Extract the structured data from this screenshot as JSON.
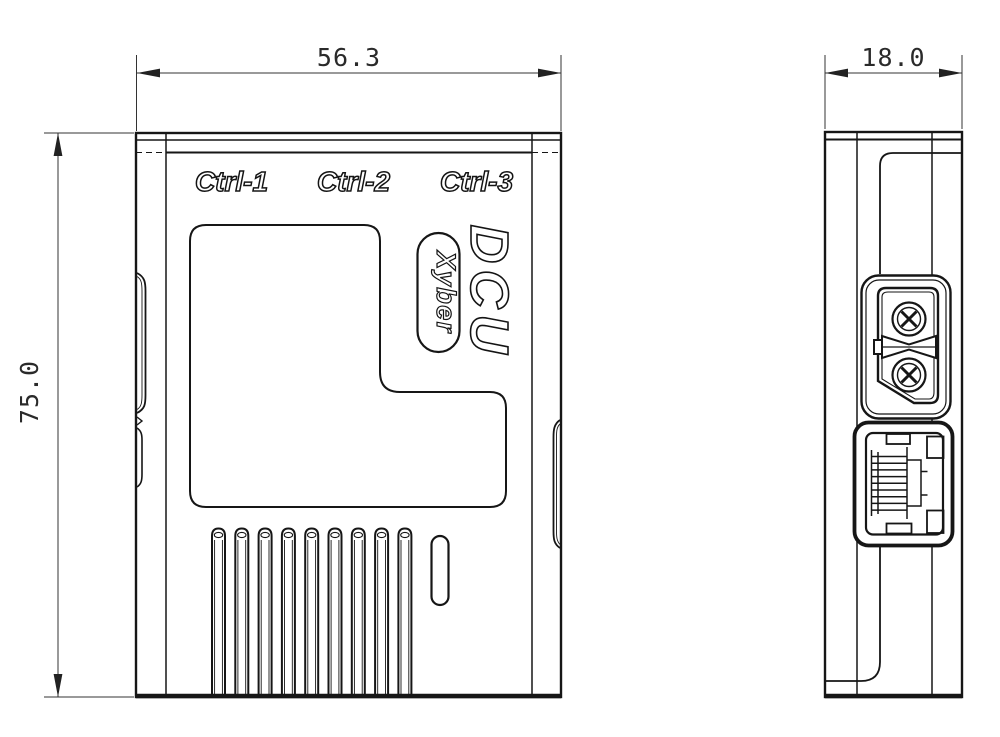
{
  "front_view": {
    "ctrl_labels": [
      "Ctrl-1",
      "Ctrl-2",
      "Ctrl-3"
    ],
    "logo": "DCU",
    "brand": "Xyber",
    "width_dim": "56.3",
    "height_dim": "75.0",
    "vent_slots": 9
  },
  "side_view": {
    "depth_dim": "18.0"
  },
  "colors": {
    "line": "#161616",
    "dim_line": "#333333",
    "background": "#ffffff"
  }
}
